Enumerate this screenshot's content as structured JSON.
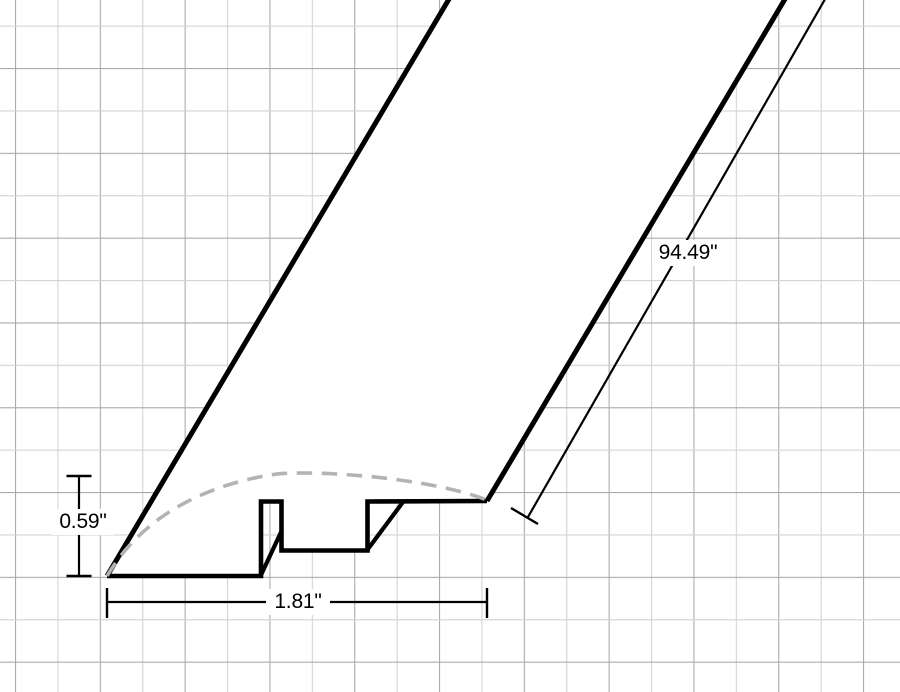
{
  "diagram": {
    "dimension_labels": {
      "height": "0.59\"",
      "width": "1.81\"",
      "length": "94.49\""
    },
    "colors": {
      "background": "#ffffff",
      "outline": "#000000",
      "dashed_profile_curve": "#b3b3b3",
      "grid_major": "#ababab",
      "grid_minor": "#d4d4d4",
      "label_text": "#000000"
    },
    "grid_spacing_px": 42.4
  }
}
